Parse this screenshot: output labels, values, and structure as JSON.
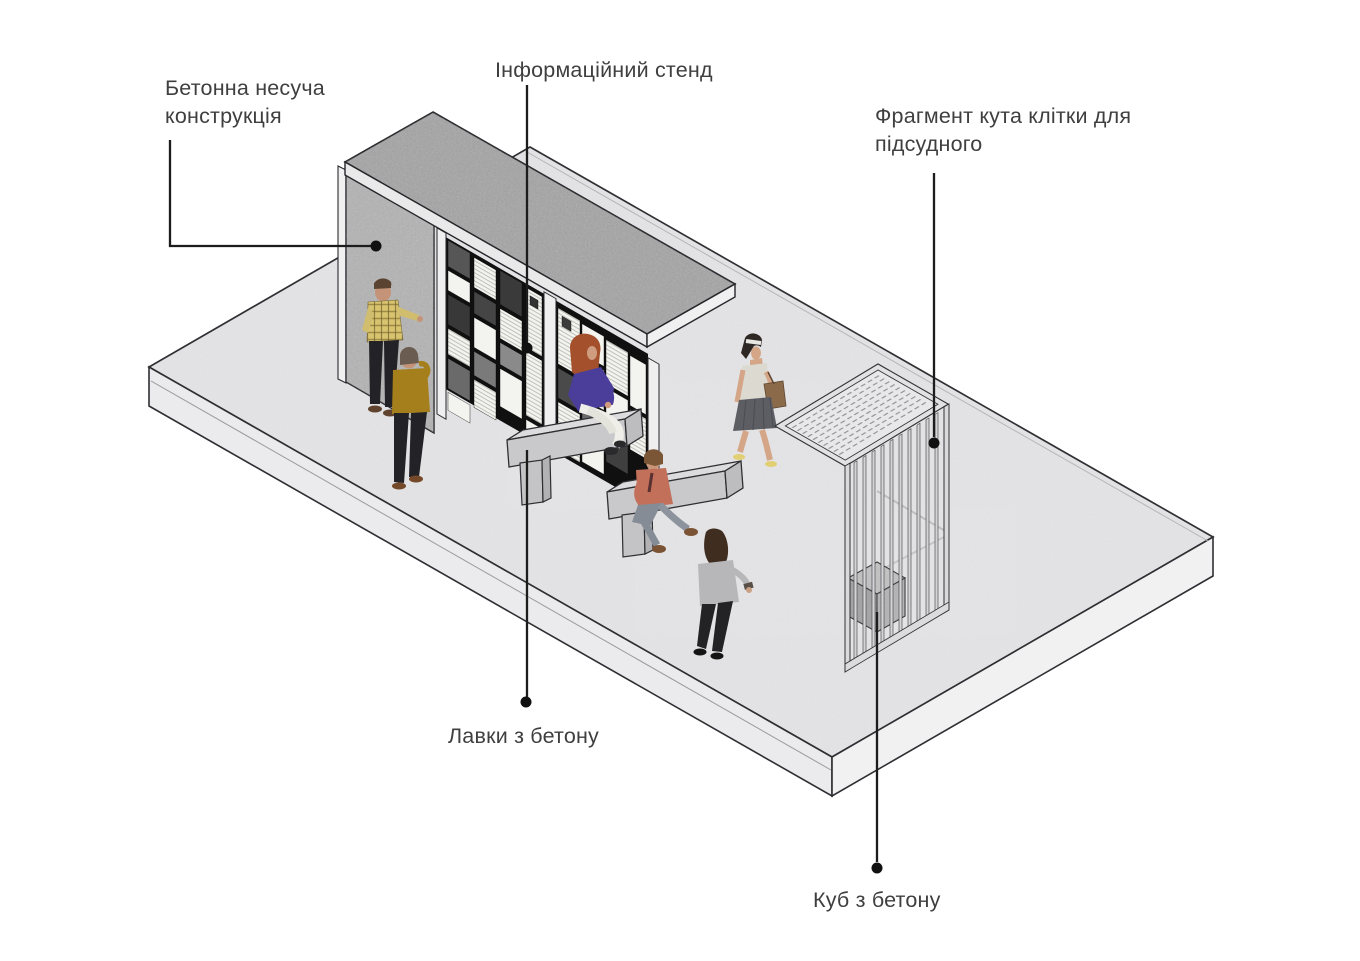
{
  "diagram": {
    "title_present": false,
    "background_color": "#ffffff",
    "leader_line_color": "#1c1c1c",
    "text_color": "#3f3f3f",
    "labels": {
      "concrete_structure": {
        "line1": "Бетонна несуча",
        "line2": "конструкція"
      },
      "info_stand": {
        "text": "Інформаційний стенд"
      },
      "cage_fragment": {
        "line1": "Фрагмент кута клітки для",
        "line2": "підсудного"
      },
      "benches": {
        "text": "Лавки з бетону"
      },
      "cube": {
        "text": "Куб з бетону"
      }
    },
    "scene_objects": [
      "concrete-platform",
      "concrete-load-bearing-wall",
      "concrete-canopy-roof",
      "information-stand-panels",
      "concrete-bench-1",
      "concrete-bench-2",
      "defendant-cage-corner-fragment",
      "concrete-cube"
    ],
    "people": [
      "man-plaid-shirt-standing-at-wall",
      "man-olive-sweater-standing",
      "woman-purple-sweater-sitting-bench-1",
      "man-salmon-shirt-sitting-bench-2",
      "woman-tank-top-walking",
      "woman-gray-sweater-standing"
    ],
    "colors": {
      "platform_top": "#e4e4e6",
      "concrete_texture": "#a4a4a4",
      "panel_background": "#101010",
      "page_white": "#f3f3ef",
      "cage_bar": "#d4d4d7",
      "outline": "#2f2f33"
    }
  }
}
